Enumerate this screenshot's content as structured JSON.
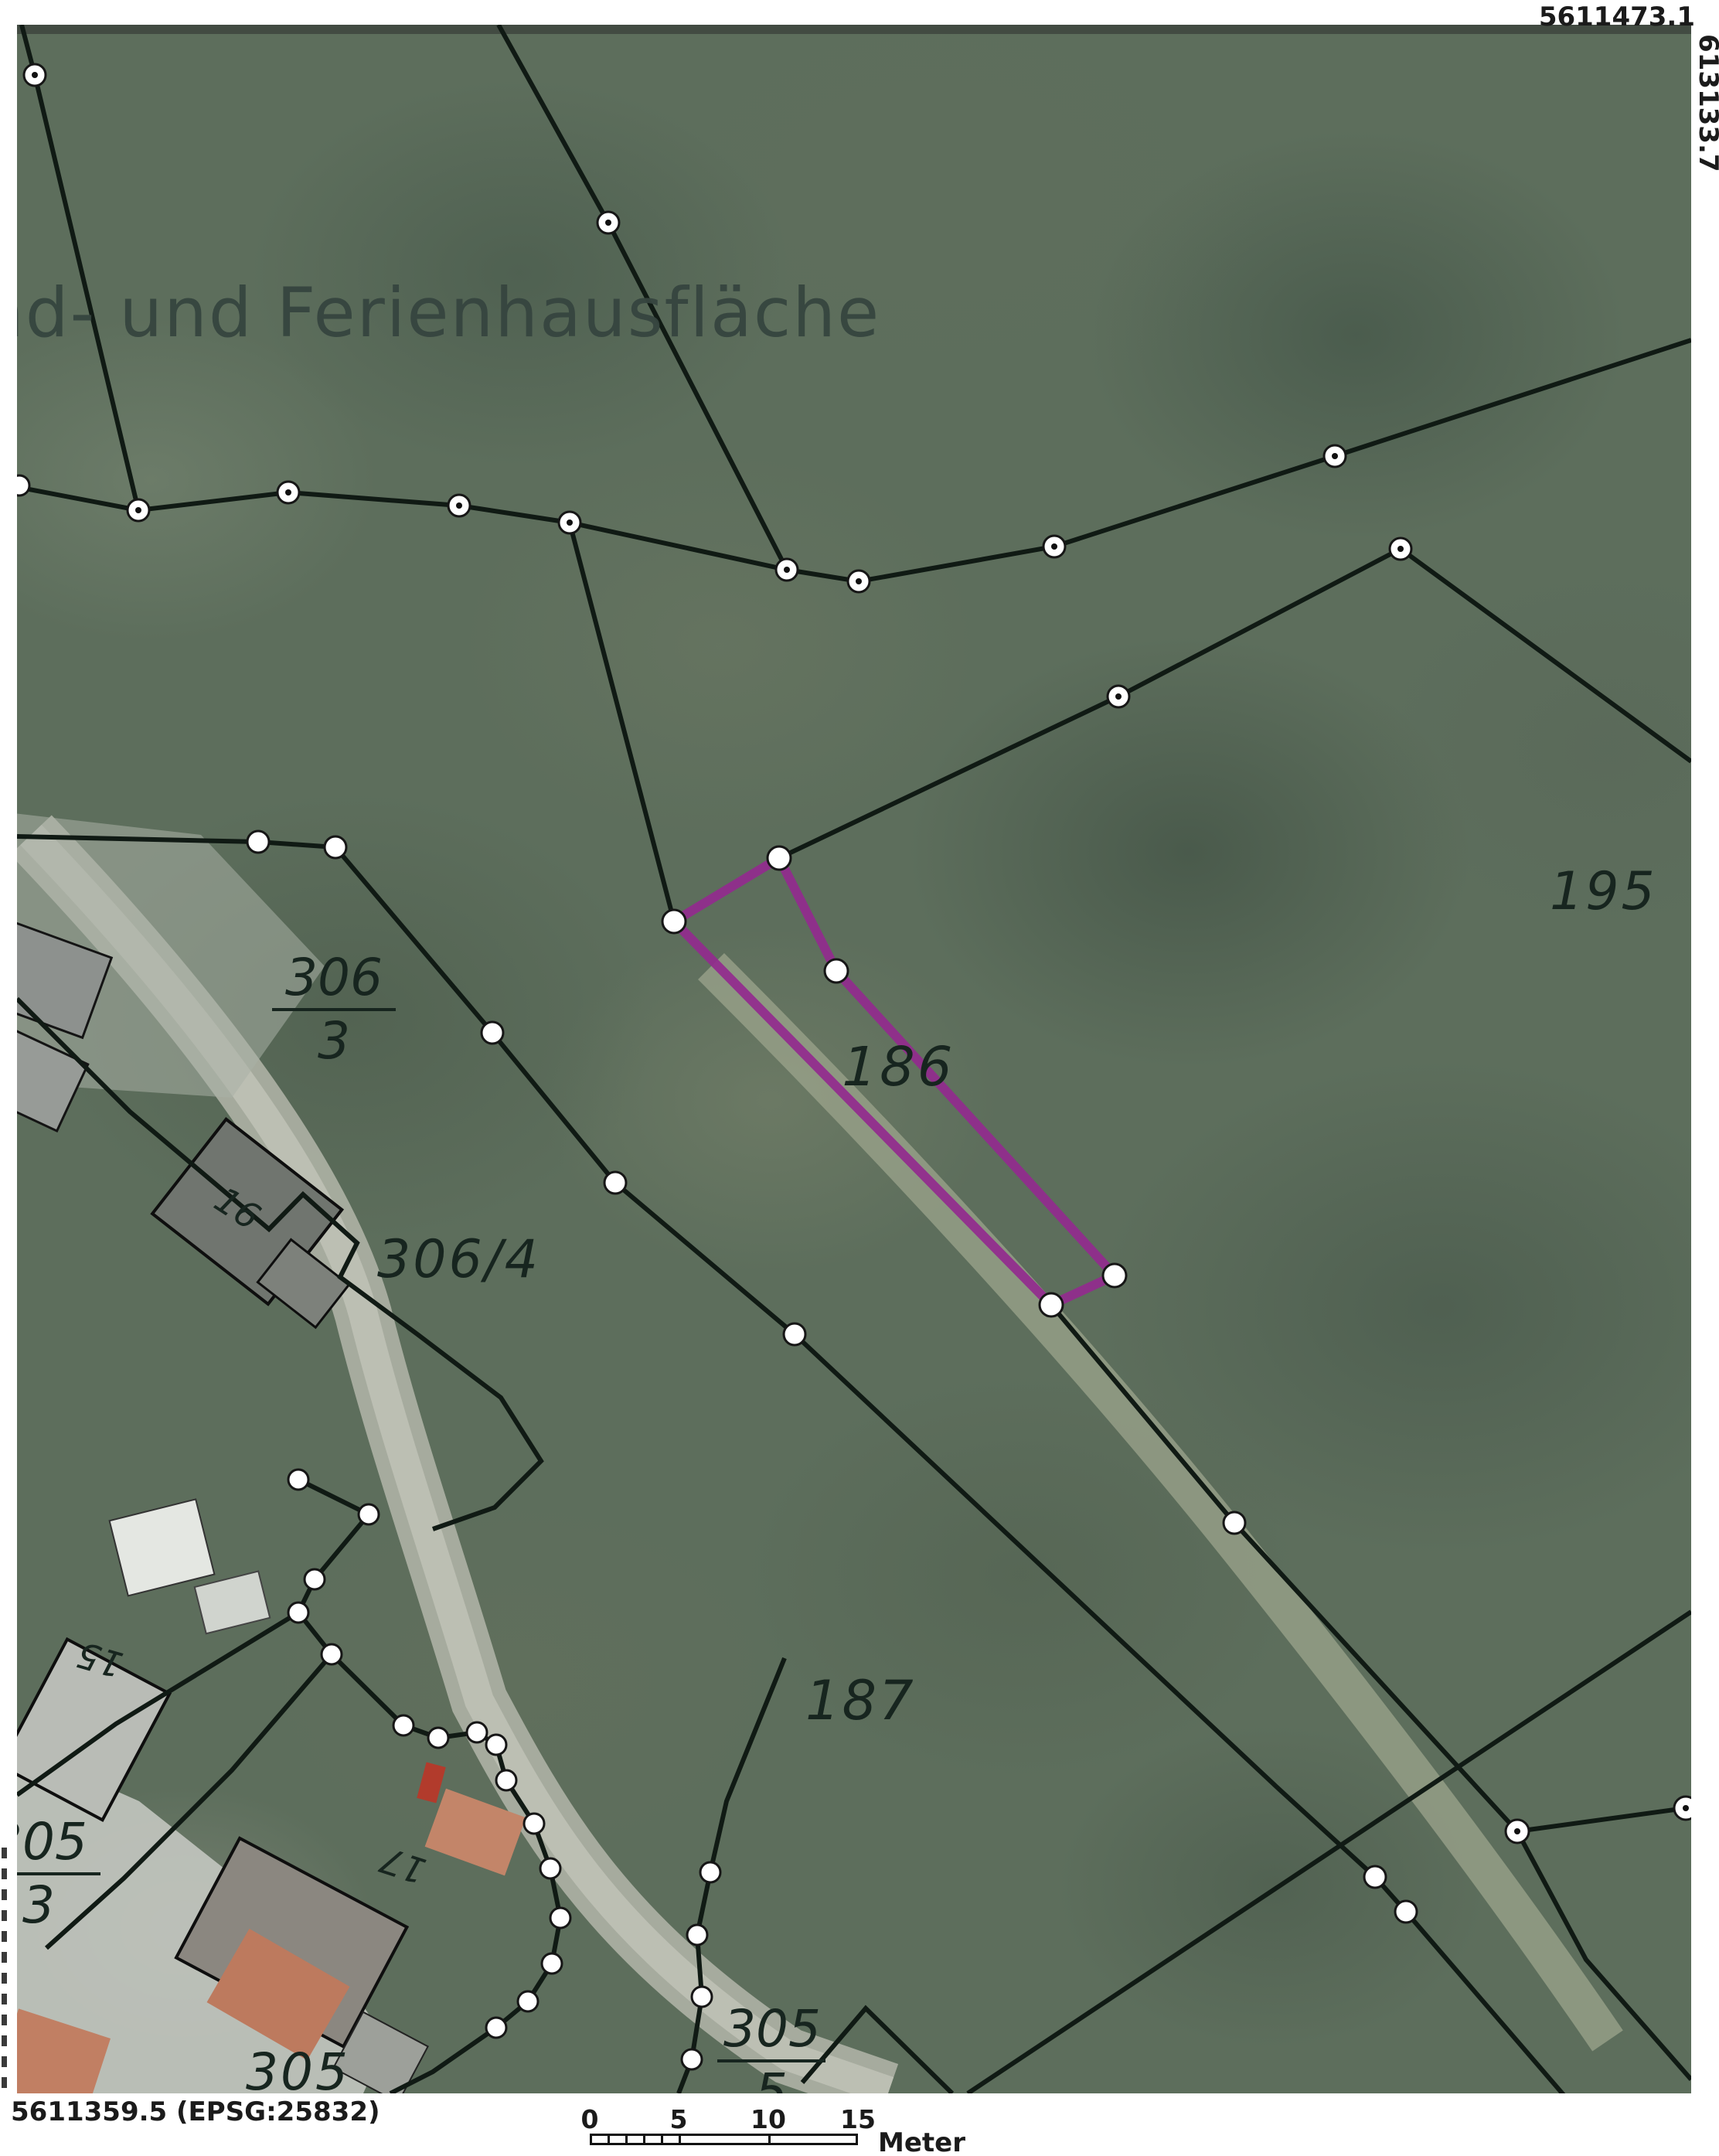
{
  "map": {
    "area_label": "nd- und Ferienhausfläche",
    "parcel_labels": {
      "p186": "186",
      "p195": "195",
      "p187": "187",
      "p306_4": "306/4",
      "p305": "305"
    },
    "parcel_fractions": {
      "f306_3": {
        "num": "306",
        "den": "3"
      },
      "f305_3": {
        "num": "305",
        "den": "3"
      },
      "f305_5": {
        "num": "305",
        "den": "5"
      }
    },
    "house_numbers": {
      "h16": "16",
      "h15": "15",
      "h17": "17"
    },
    "highlight_color": "#932a8e",
    "boundary_color": "#101a14"
  },
  "coordinates": {
    "top_right": "5611473.1",
    "right_edge": "613133.7",
    "bottom_left": "5611359.5 (EPSG:25832)"
  },
  "scalebar": {
    "ticks": [
      "0",
      "5",
      "10",
      "15"
    ],
    "unit": "Meter"
  }
}
